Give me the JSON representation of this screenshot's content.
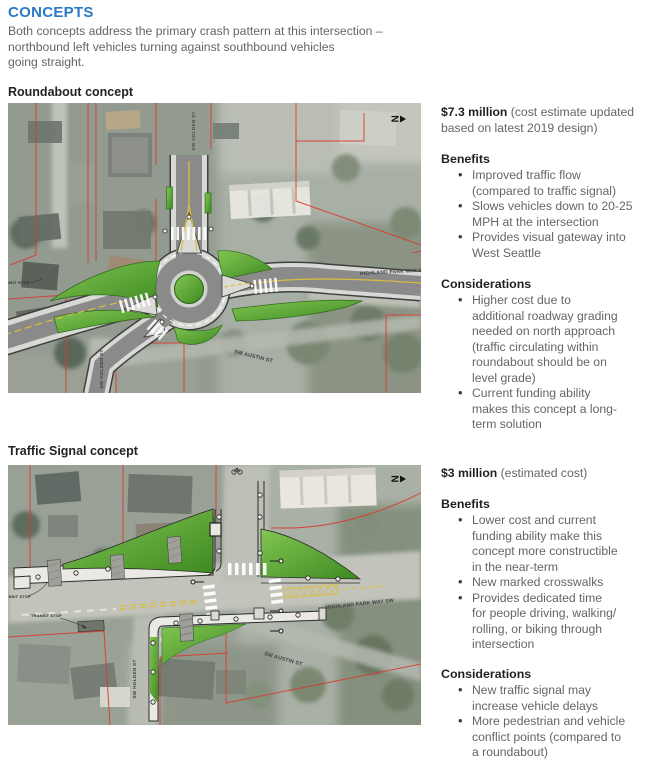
{
  "page": {
    "title": "CONCEPTS",
    "intro": "Both concepts address the primary crash pattern at this intersection –\nnorthbound left vehicles turning against southbound vehicles\ngoing straight."
  },
  "roundabout": {
    "heading": "Roundabout concept",
    "cost_amount": "$7.3 million",
    "cost_note": "(cost estimate updated\nbased on latest 2019 design)",
    "benefits_heading": "Benefits",
    "benefits": [
      "Improved traffic flow\n(compared to traffic signal)",
      "Slows vehicles down to 20-25\nMPH at the intersection",
      "Provides visual gateway into\nWest Seattle"
    ],
    "considerations_heading": "Considerations",
    "considerations": [
      "Higher cost due to\nadditional roadway grading\nneeded on north approach\n(traffic circulating within\nroundabout should be on\nlevel grade)",
      "Current funding ability\nmakes this concept a long-\nterm solution"
    ],
    "map": {
      "north_letter": "N",
      "labels": {
        "holden_top": "SW HOLDEN ST",
        "highland_park": "HIGHLAND PARK WAY SW",
        "austin": "SW AUSTIN ST",
        "holden_bottom": "SW HOLDEN ST",
        "transit_stop": "TRANSIT STOP"
      }
    }
  },
  "signal": {
    "heading": "Traffic Signal concept",
    "cost_amount": "$3 million",
    "cost_note": "(estimated cost)",
    "benefits_heading": "Benefits",
    "benefits": [
      "Lower cost and current\nfunding ability make this\nconcept more constructible\nin the near-term",
      "New marked crosswalks",
      "Provides dedicated time\nfor people driving, walking/\nrolling, or biking through\nintersection"
    ],
    "considerations_heading": "Considerations",
    "considerations": [
      "New traffic signal may\nincrease vehicle delays",
      "More pedestrian and vehicle\nconflict points (compared to\na roundabout)"
    ],
    "map": {
      "north_letter": "N",
      "labels": {
        "transit_stop_1": "TRANSIT STOP",
        "transit_stop_2": "TRANSIT STOP",
        "highland_park": "HIGHLAND PARK WAY SW",
        "austin": "SW AUSTIN ST",
        "holden": "SW HOLDEN ST"
      }
    }
  }
}
